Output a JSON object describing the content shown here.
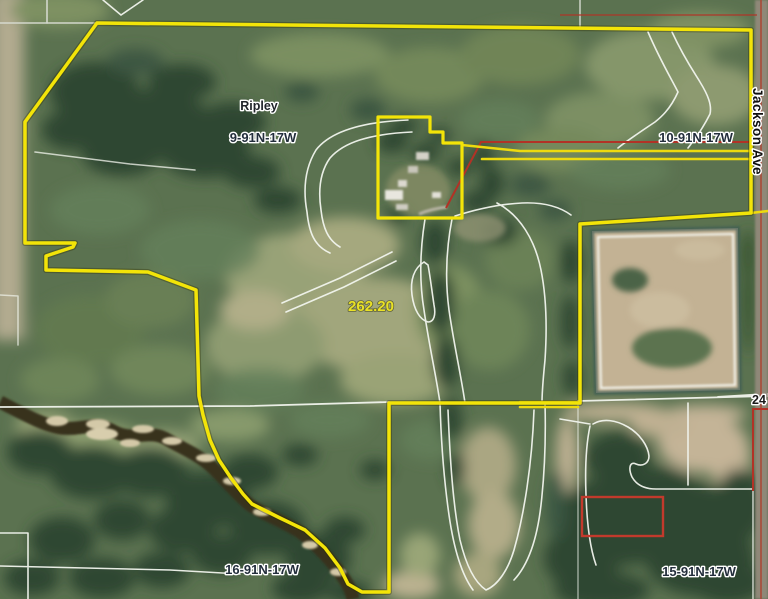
{
  "map": {
    "type": "aerial-parcel-map",
    "parcel": {
      "acreage_label": "262.20"
    },
    "labels": {
      "town": "Ripley",
      "section_nw": "9-91N-17W",
      "section_ne": "10-91N-17W",
      "section_sw": "16-91N-17W",
      "section_se": "15-91N-17W",
      "road": "Jackson Ave",
      "section_number": "24"
    },
    "colors": {
      "parcel_yellow": "#f3e408",
      "road_yellow": "#eeda0e",
      "survey_red": "#b23226",
      "highlight_red": "#c23a2c",
      "field_white": "#f2f5ee",
      "label_dark": "#232e3c",
      "acreage_yellow": "#e9e126"
    }
  }
}
